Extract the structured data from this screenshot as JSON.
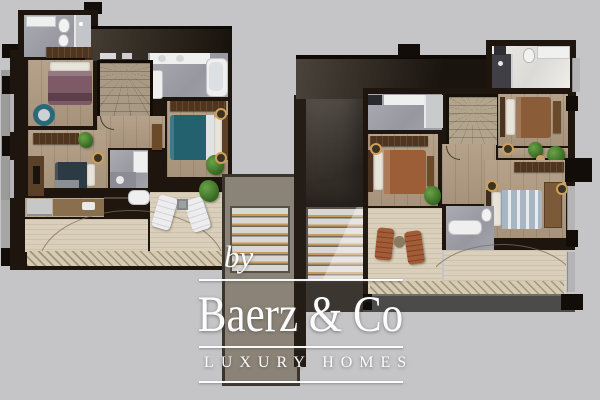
{
  "image_type": "real-estate floor plan render with agency watermark",
  "watermark": {
    "prefix": "by",
    "brand": "Baerz & Co",
    "tagline": "LUXURY HOMES"
  },
  "palette": {
    "background": "#c5c5c7",
    "wall_dark": "#1d150e",
    "wood_floor": "#b19c83",
    "terrace_deck": "#d9cfba",
    "bathroom_tile": "#9fa0a8",
    "white_marble": "#e9e7e3",
    "stair_shaft_taupe": "#8b8377",
    "stair_tread_gold": "#c59a5a",
    "bed_mauve": "#7d5a66",
    "bed_teal": "#23616e",
    "bed_navy": "#2c3a46",
    "bed_brown": "#8a5c38",
    "bed_rust": "#9c5e36",
    "bed_blue_stripe": "#a8b6c4",
    "plant_green": "#3e7a35",
    "watermark_white": "#fcfcfc"
  },
  "plans": {
    "left_unit": {
      "name": "left-floor-plan",
      "rooms": [
        "bathroom-top",
        "bedroom-mauve",
        "winder-staircase",
        "bathroom-ensuite",
        "bedroom-teal",
        "bedroom-navy",
        "shower-room",
        "kitchen",
        "living-terrace"
      ],
      "furniture": [
        "double-bed",
        "double-bed",
        "double-bed",
        "round-armchair",
        "sun-lounger",
        "sun-lounger",
        "side-table",
        "potted-plant",
        "bathtub",
        "kitchen-island"
      ]
    },
    "right_unit": {
      "name": "right-floor-plan",
      "rooms": [
        "bathroom-top-right",
        "bedroom-brown",
        "winder-staircase",
        "bathroom-left",
        "bedroom-rust",
        "bedroom-blue",
        "shower-room",
        "living-terrace"
      ],
      "furniture": [
        "double-bed",
        "double-bed",
        "double-bed",
        "sun-lounger",
        "sun-lounger",
        "side-table",
        "potted-plants",
        "bathtub",
        "wardrobe"
      ]
    },
    "connector": {
      "name": "central-stair-shaft",
      "features": [
        "stair-flight-left",
        "stair-flight-right"
      ]
    }
  }
}
